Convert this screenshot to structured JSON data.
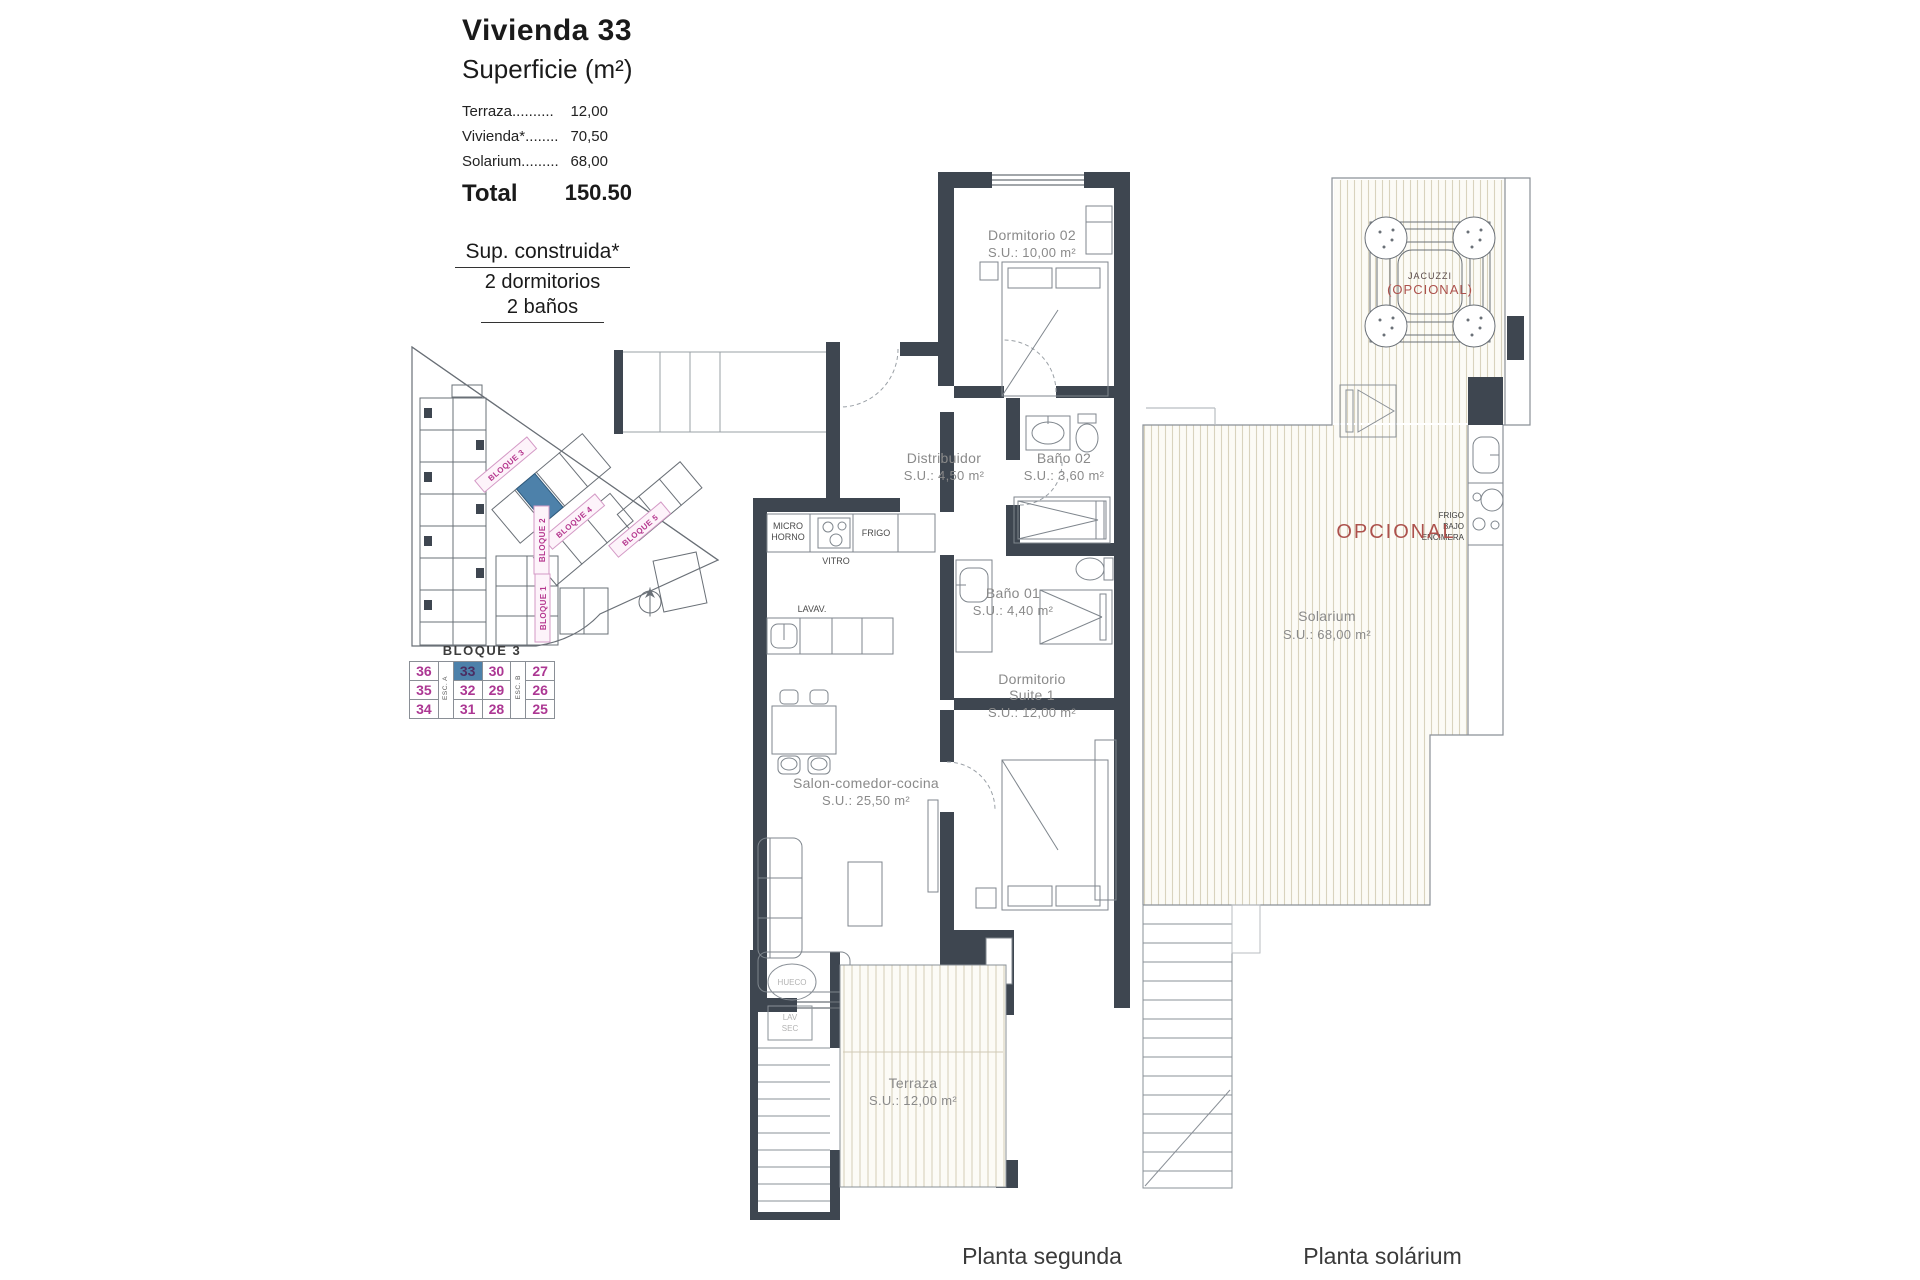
{
  "info": {
    "title": "Vivienda 33",
    "subtitle": "Superficie (m²)",
    "rows": [
      {
        "label": "Terraza..........",
        "value": "12,00"
      },
      {
        "label": "Vivienda*........",
        "value": "70,50"
      },
      {
        "label": "Solarium.........",
        "value": "68,00"
      }
    ],
    "total_label": "Total",
    "total_value": "150.50",
    "built_title": "Sup. construida*",
    "built_line2": "2 dormitorios",
    "built_line3": "2 baños"
  },
  "site_plan": {
    "labels": {
      "b1": "BLOQUE 1",
      "b2": "BLOQUE 2",
      "b3": "BLOQUE 3",
      "b4": "BLOQUE 4",
      "b5": "BLOQUE 5"
    },
    "highlight_color": "#4d81aa"
  },
  "block_table": {
    "title": "BLOQUE 3",
    "stair_a": "ESC. A",
    "stair_b": "ESC. B",
    "rows": [
      [
        "36",
        "33",
        "30",
        "27"
      ],
      [
        "35",
        "32",
        "29",
        "26"
      ],
      [
        "34",
        "31",
        "28",
        "25"
      ]
    ],
    "highlighted_unit": "33"
  },
  "planta_segunda": {
    "caption": "Planta segunda",
    "dorm02": {
      "name": "Dormitorio 02",
      "area": "S.U.: 10,00 m²"
    },
    "distribuidor": {
      "name": "Distribuidor",
      "area": "S.U.: 4,50 m²"
    },
    "bano02": {
      "name": "Baño 02",
      "area": "S.U.: 3,60 m²"
    },
    "bano01": {
      "name": "Baño 01",
      "area": "S.U.: 4,40 m²"
    },
    "suite": {
      "name": "Dormitorio",
      "name2": "Suite 1",
      "area": "S.U.: 12,00 m²"
    },
    "salon": {
      "name": "Salon-comedor-cocina",
      "area": "S.U.: 25,50 m²"
    },
    "terraza": {
      "name": "Terraza",
      "area": "S.U.: 12,00 m²"
    },
    "kitchen": {
      "micro1": "MICRO",
      "micro2": "HORNO",
      "vitro": "VITRO",
      "frigo": "FRIGO",
      "lavav": "LAVAV."
    },
    "stairs": {
      "hueco": "HUECO",
      "lav1": "LAV",
      "lav2": "SEC"
    }
  },
  "planta_solarium": {
    "caption": "Planta solárium",
    "solarium": {
      "name": "Solarium",
      "area": "S.U.: 68,00 m²"
    },
    "opcional": "OPCIONAL",
    "jacuzzi": {
      "name": "JACUZZI",
      "note": "(OPCIONAL)"
    },
    "kitchenette": {
      "l1": "FRIGO",
      "l2": "BAJO",
      "l3": "ENCIMERA"
    }
  }
}
